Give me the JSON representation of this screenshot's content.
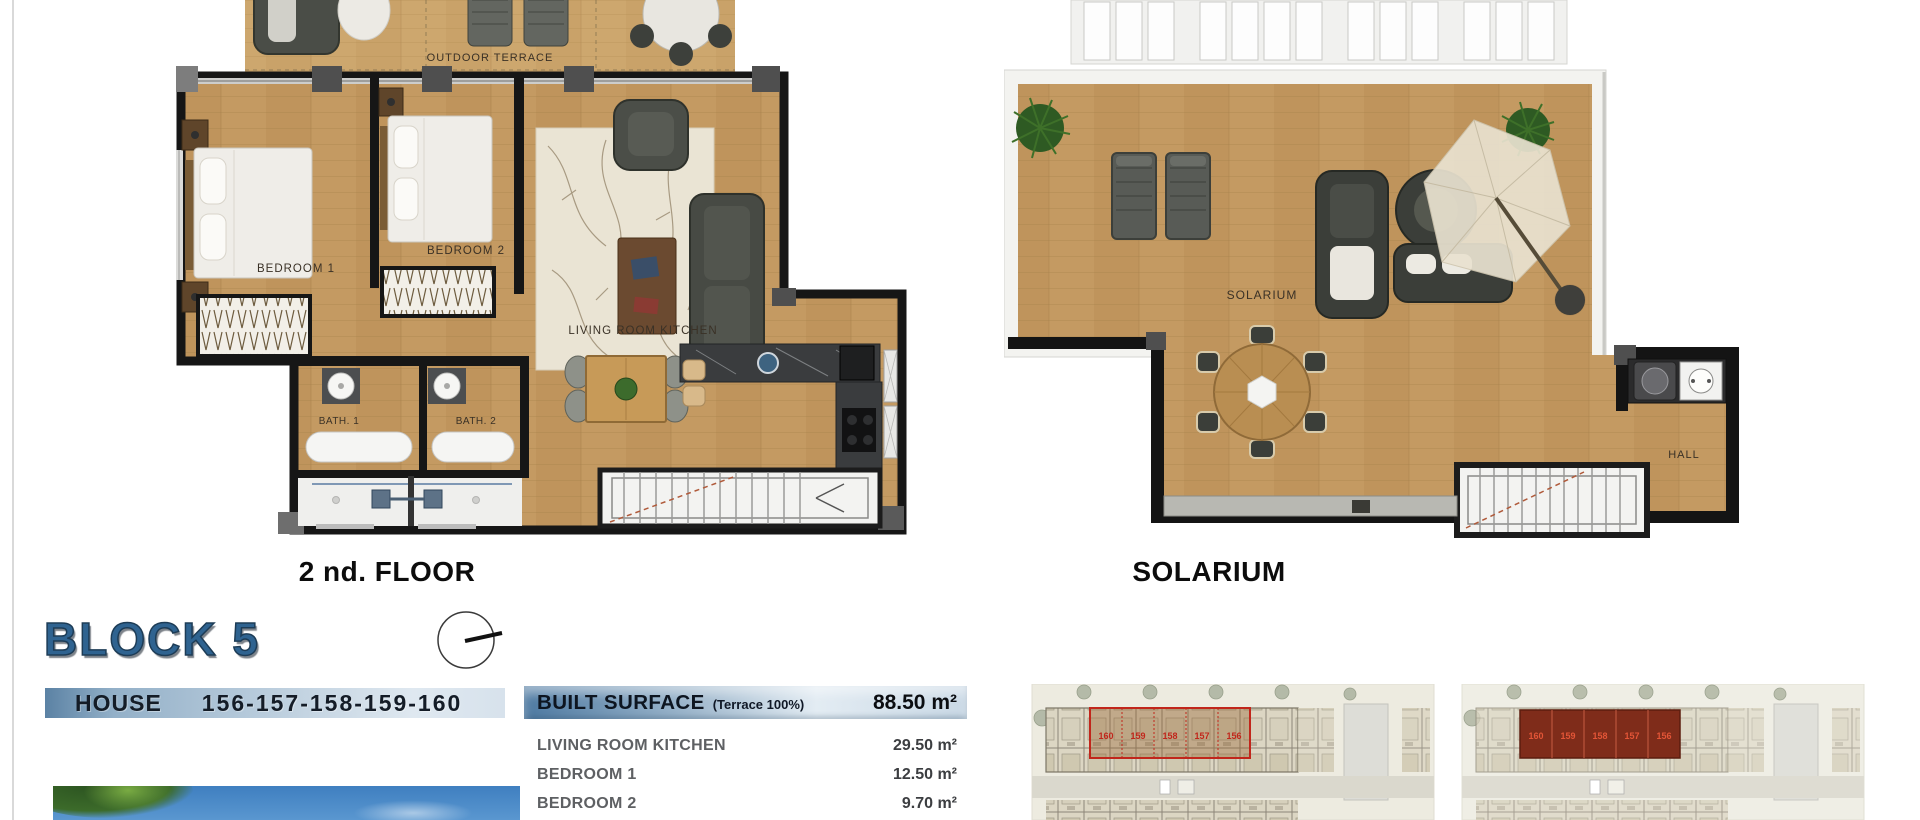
{
  "captions": {
    "floor": "2 nd. FLOOR",
    "solarium": "SOLARIUM"
  },
  "floor_plan": {
    "outdoor_terrace": "OUTDOOR TERRACE",
    "bedroom1": "BEDROOM 1",
    "bedroom2": "BEDROOM 2",
    "living": "LIVING ROOM KITCHEN",
    "bath1": "BATH. 1",
    "bath2": "BATH. 2"
  },
  "solarium_plan": {
    "solarium": "SOLARIUM",
    "hall": "HALL"
  },
  "block": {
    "title": "BLOCK 5",
    "house_label": "HOUSE",
    "house_numbers": "156-157-158-159-160"
  },
  "surface_table": {
    "header_label": "BUILT SURFACE",
    "header_note": "(Terrace 100%)",
    "header_value": "88.50 m²",
    "rows": [
      {
        "label": "LIVING ROOM KITCHEN",
        "value": "29.50 m²"
      },
      {
        "label": "BEDROOM 1",
        "value": "12.50 m²"
      },
      {
        "label": "BEDROOM 2",
        "value": "9.70 m²"
      }
    ]
  },
  "site_plans": {
    "unit_numbers": [
      "160",
      "159",
      "158",
      "157",
      "156"
    ]
  },
  "colors": {
    "accent_blue": "#2f6390",
    "bar_gradient_start": "#5b82a4",
    "bar_gradient_end": "#dfe8f0",
    "highlight_red": "#c1261b",
    "wood": "#c49a62",
    "wall": "#141414"
  }
}
